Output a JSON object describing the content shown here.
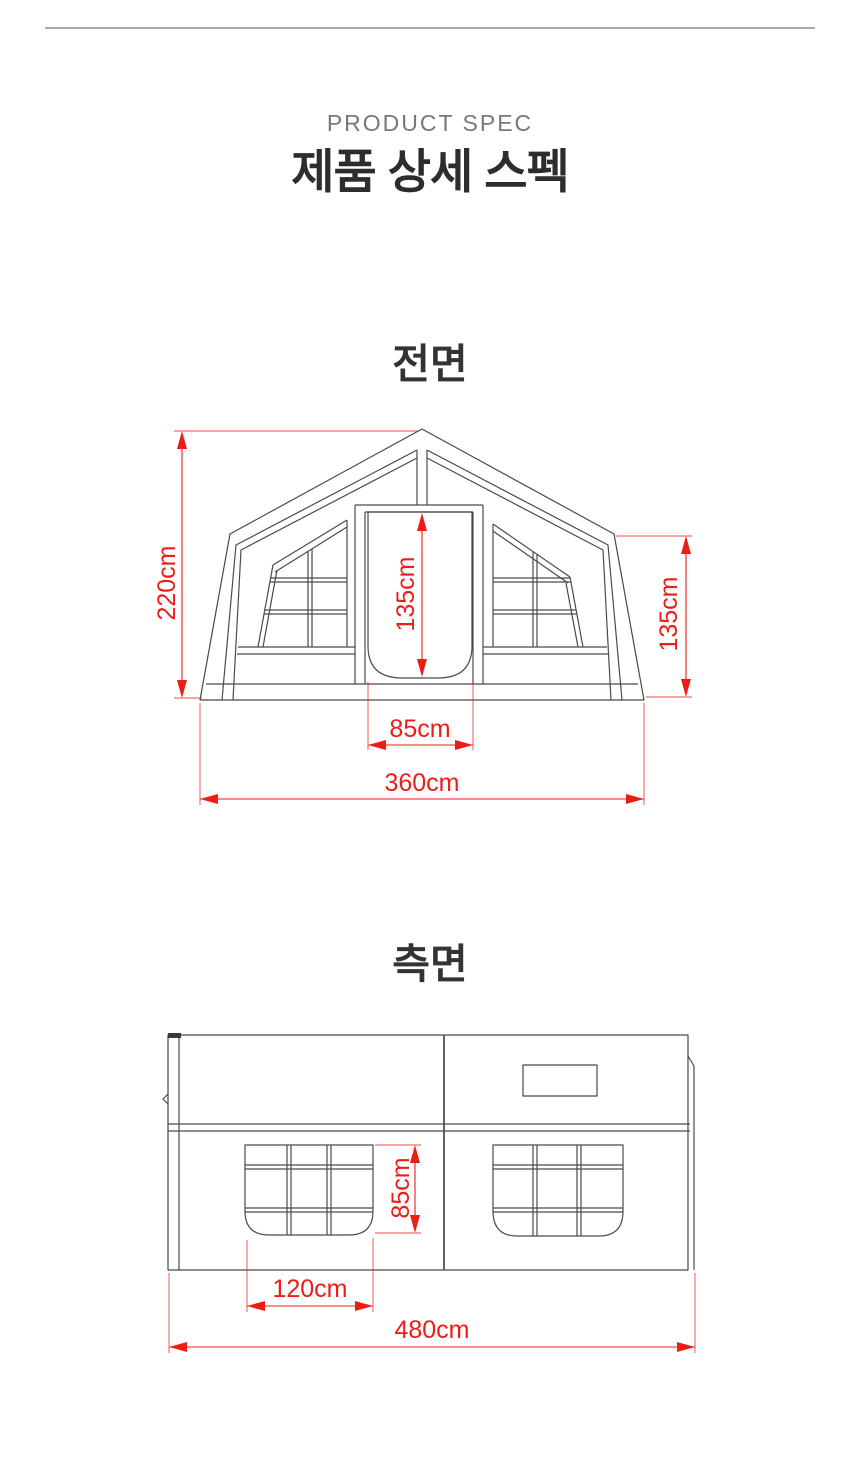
{
  "page": {
    "background": "#ffffff",
    "accent_red": "#ed1c16",
    "line_gray": "#4a4a4a",
    "divider_gray": "#a8a8a8"
  },
  "header": {
    "eyebrow": "PRODUCT SPEC",
    "title": "제품 상세 스펙"
  },
  "front_view": {
    "heading": "전면",
    "dimensions": {
      "total_height": "220cm",
      "door_height": "135cm",
      "wall_height": "135cm",
      "door_width": "85cm",
      "total_width": "360cm"
    }
  },
  "side_view": {
    "heading": "측면",
    "dimensions": {
      "window_height": "85cm",
      "window_width": "120cm",
      "total_length": "480cm"
    }
  }
}
